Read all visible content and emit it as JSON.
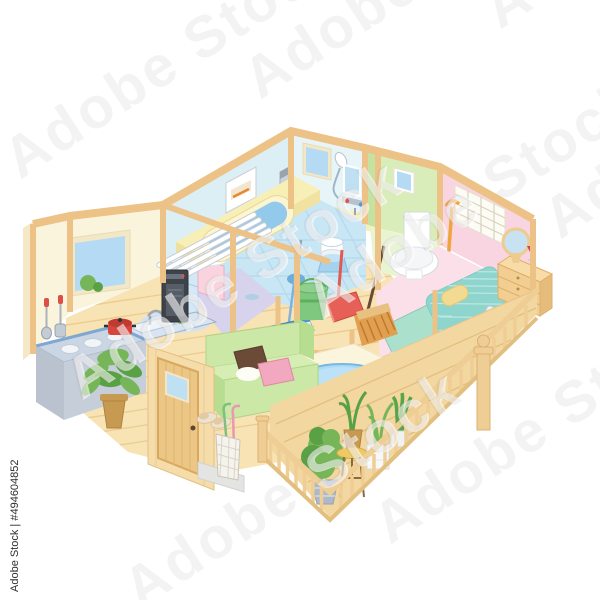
{
  "artwork": {
    "kind": "stock illustration preview",
    "subject": "isometric cutaway of a single-story home interior with furniture and cleaning tools",
    "background": "#FFFFFF"
  },
  "watermark": {
    "diagonal_text": "Adobe Stock",
    "side_text": "Adobe Stock | #494604852",
    "asset_id": "#494604852"
  },
  "palette": {
    "beam": "#EDC286",
    "beam_dark": "#DCA963",
    "wood_floor": "#F8E3B4",
    "wood_line": "#EACB90",
    "deck": "#F3D7A0",
    "deck_line": "#E2BF7E",
    "railing": "#EFCE95",
    "wall_cream": "#FBF4DC",
    "wall_cream_shade": "#F4E8C6",
    "wall_cyan": "#DCEFF4",
    "wall_cyan_light": "#E8F5F8",
    "wall_lavender": "#DDCCEA",
    "wall_pink_bedroom": "#F8D5E0",
    "wall_green_a": "#C6E2A0",
    "wall_green_b": "#D9EDBA",
    "floor_tile": "#C8E6F4",
    "tile_line": "#A9D4EA",
    "floor_toilet": "#E9F4D2",
    "floor_bedroom": "#FBE0EA",
    "bathtub_yellow": "#F8EFB6",
    "water_blue": "#93CAEC",
    "window_blue": "#B5DBF4",
    "sofa_green": "#CBE8A6",
    "rug_cream": "#FBF5DE",
    "table_blue": "#ABDAF3",
    "futon_teal": "#ABE0CC",
    "quilt_teal": "#8ED5CD",
    "pillow_yellow": "#F3DA92",
    "plant_green": "#76B659",
    "plant_dark": "#59A144",
    "pot_brown": "#C79A52",
    "appliance_black": "#3E4349",
    "metal_gray": "#C3CBD4",
    "accent_red": "#DD4F45",
    "mat_purple": "#D7D3EC",
    "mat_blue": "#D3E2F0",
    "cabinet_blue": "#D3E9F8",
    "cabinet_pink": "#F9D4DF",
    "watermark_gray": "#787878"
  },
  "rooms": [
    {
      "name": "kitchen",
      "items": [
        "window with garden view",
        "hanging ladle and turner",
        "stove counter with burners",
        "red pot",
        "sink with faucet",
        "soap bottle",
        "potted plant",
        "fan heater on oval mat"
      ]
    },
    {
      "name": "washroom",
      "items": [
        "towel rack",
        "mirror cabinet",
        "vanity sink",
        "drawer cabinet",
        "purple floor mat"
      ]
    },
    {
      "name": "bathroom",
      "items": [
        "control panel",
        "water heater",
        "window",
        "shower head",
        "mirror",
        "faucet",
        "bathtub with water",
        "folding bath lid",
        "tiled floor",
        "wash bowl",
        "bath stool",
        "plunger"
      ]
    },
    {
      "name": "toilet-room",
      "items": [
        "small window",
        "toilet"
      ]
    },
    {
      "name": "bedroom",
      "items": [
        "shoji window",
        "walking cane",
        "dresser with round mirror",
        "futon with quilt",
        "pillow",
        "lint roller"
      ]
    },
    {
      "name": "living-room",
      "items": [
        "front door",
        "entry step",
        "slippers",
        "umbrella stand",
        "sofa with cushions",
        "rug",
        "round table",
        "air purifier"
      ]
    },
    {
      "name": "hallway",
      "items": [
        "flat mop",
        "green bucket",
        "red dustpan",
        "broom"
      ]
    },
    {
      "name": "balcony",
      "items": [
        "wood deck",
        "railing with balusters",
        "finial post",
        "topiary pot",
        "plant stand",
        "square planter",
        "snake plant"
      ]
    }
  ]
}
